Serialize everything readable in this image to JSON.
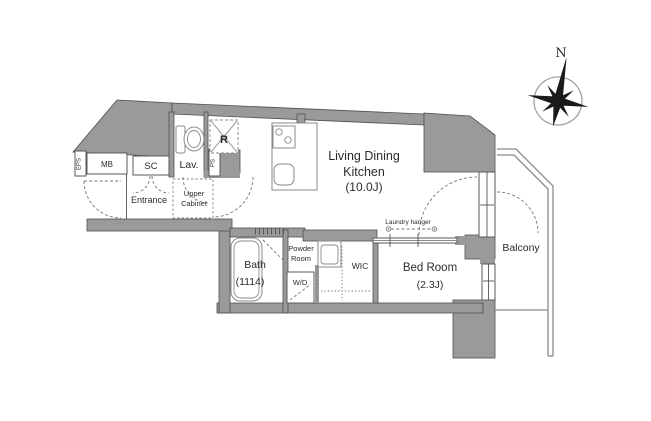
{
  "plan": {
    "title": "apartment-floor-plan",
    "compass": {
      "north_label": "N"
    },
    "rooms": {
      "ldk": {
        "line1": "Living Dining",
        "line2": "Kitchen",
        "size": "(10.0J)"
      },
      "bedroom": {
        "name": "Bed Room",
        "size": "(2.3J)"
      },
      "bath": {
        "name": "Bath",
        "size": "(1114)"
      },
      "powder_room": {
        "line1": "Powder",
        "line2": "Room"
      },
      "wic": {
        "name": "WIC"
      },
      "entrance": {
        "name": "Entrance"
      },
      "balcony": {
        "name": "Balcony"
      },
      "lavatory": {
        "name": "Lav."
      },
      "shoe_closet": {
        "name": "SC"
      },
      "meter_box": {
        "name": "MB"
      },
      "eps_shaft": {
        "name": "EPS"
      },
      "pipe_space": {
        "name": "PS"
      },
      "refrigerator": {
        "name": "R"
      },
      "upper_cabinet": {
        "line1": "Upper",
        "line2": "Cabinet"
      },
      "washer_dryer": {
        "name": "W/D"
      }
    },
    "annotations": {
      "laundry_hanger": "Laundry hanger"
    },
    "colors": {
      "wall": "#9a9a9a",
      "wall_stroke": "#4f4f4f",
      "fixture": "#8a8a8a",
      "text": "#2b2b2b"
    }
  }
}
